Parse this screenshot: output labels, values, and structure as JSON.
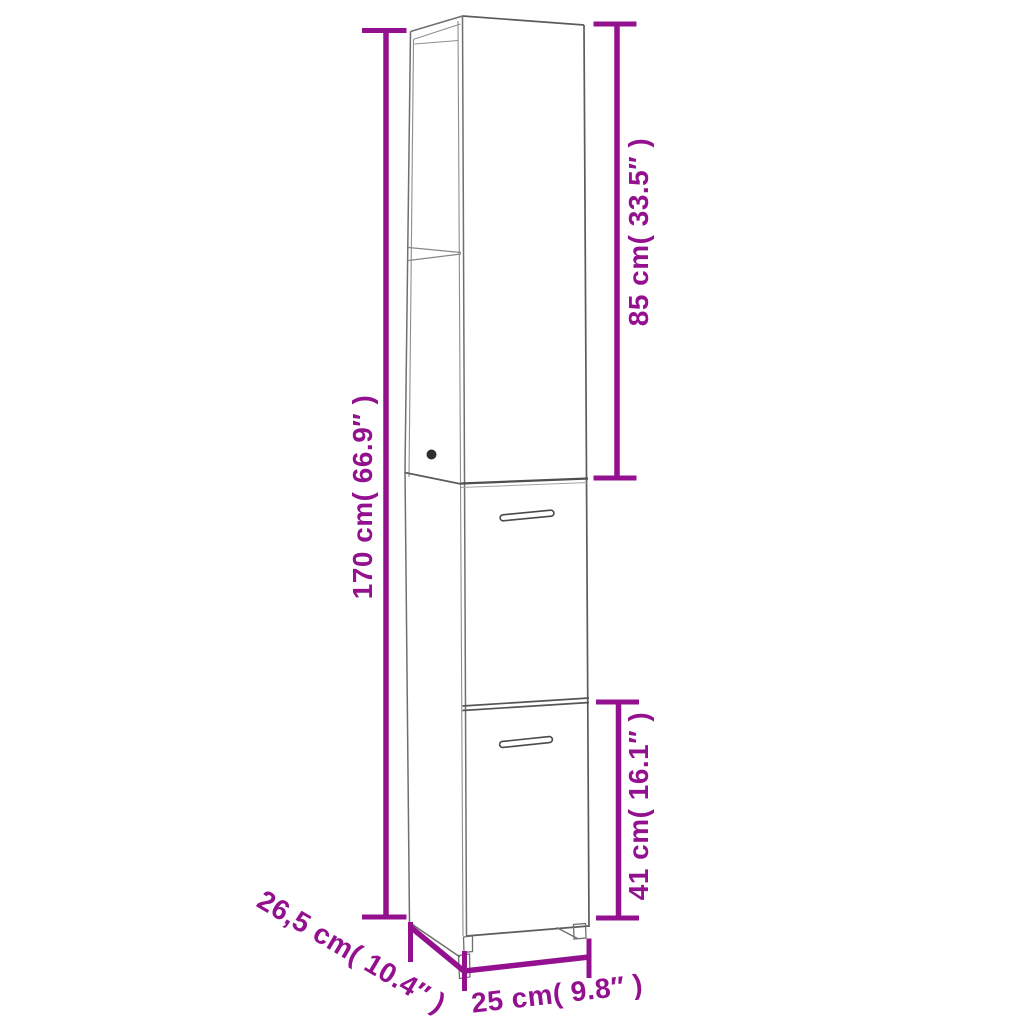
{
  "diagram": {
    "kind": "product-dimension-diagram",
    "subject": "tall narrow cabinet with open top shelf compartment and two doors"
  },
  "colors": {
    "accent": "#93108f",
    "line": "#6f6f6f",
    "background": "#ffffff"
  },
  "dimensions": {
    "total_height": {
      "label": "170 cm( 66.9″ )",
      "cm": "170",
      "inch": "66.9"
    },
    "upper_height": {
      "label": "85 cm( 33.5″ )",
      "cm": "85",
      "inch": "33.5"
    },
    "lower_height": {
      "label": "41 cm( 16.1″ )",
      "cm": "41",
      "inch": "16.1"
    },
    "depth": {
      "label": "26,5 cm( 10.4″ )",
      "cm": "26,5",
      "inch": "10.4"
    },
    "width": {
      "label": "25 cm( 9.8″ )",
      "cm": "25",
      "inch": "9.8"
    }
  }
}
